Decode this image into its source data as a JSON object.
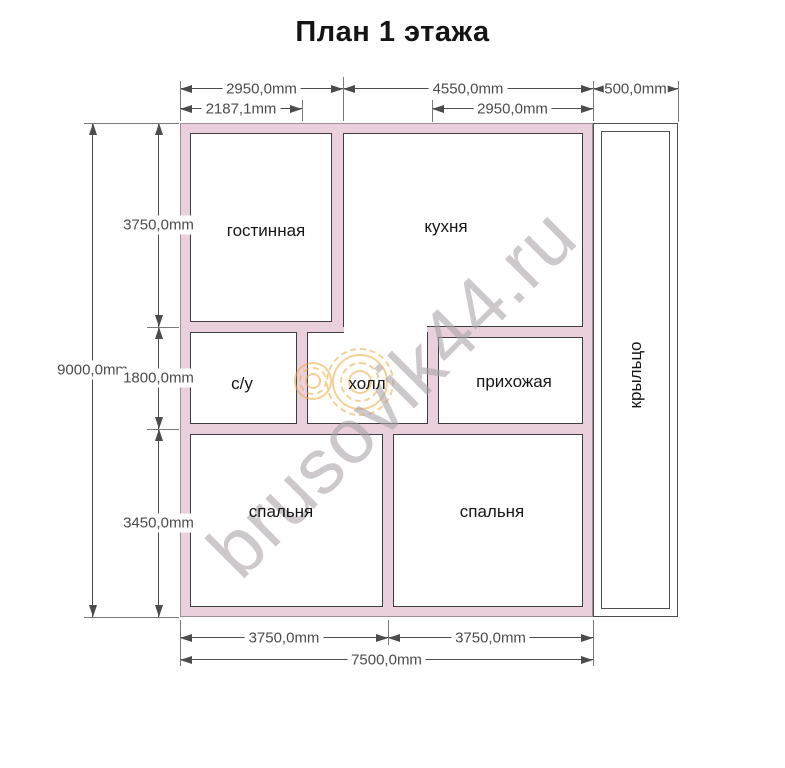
{
  "title": "План 1 этажа",
  "watermark": "brusovik44.ru",
  "rooms": {
    "living": "гостинная",
    "kitchen": "кухня",
    "bath": "с/у",
    "hall": "холл",
    "entry": "прихожая",
    "bedroom_left": "спальня",
    "bedroom_right": "спальня",
    "porch": "крыльцо"
  },
  "dims": {
    "top_living": "2950,0mm",
    "top_kitchen": "4550,0mm",
    "top_porch": "500,0mm",
    "top_bath": "2187,1mm",
    "top_entry": "2950,0mm",
    "left_total": "9000,0mm",
    "left_top": "3750,0mm",
    "left_mid": "1800,0mm",
    "left_bottom": "3450,0mm",
    "bottom_left": "3750,0mm",
    "bottom_right": "3750,0mm",
    "bottom_total": "7500,0mm"
  },
  "colors": {
    "wall-fill": "#e9d0dc",
    "wall-edge": "#9a9096",
    "room-line": "#3f3d3f",
    "dim-line": "#4c4c4c",
    "ext-line": "#7a7a7a",
    "watermark-gray": "#a8a2a6",
    "logo-orange": "#f0a843"
  }
}
